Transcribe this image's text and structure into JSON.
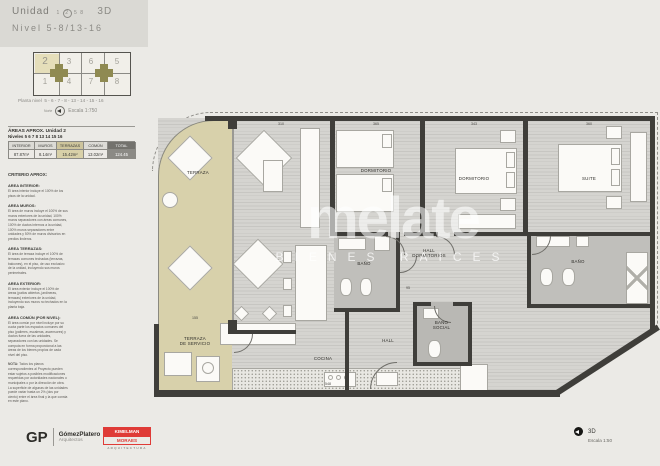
{
  "header": {
    "product_label": "Unidad",
    "unit_options": [
      "1",
      "2",
      "5",
      "8"
    ],
    "selected_unit": "2",
    "view_mode": "3D",
    "level_label": "Nivel",
    "level_range": "5-8/13-16"
  },
  "keyplan": {
    "cells": [
      "2",
      "3",
      "6",
      "5",
      "1",
      "4",
      "7",
      "8"
    ],
    "caption_label": "Planta nivel",
    "caption_levels": "5 - 6 - 7 - 8 - 13 - 14 - 15 - 16",
    "north_label": "Norte",
    "scale_label": "Escala 1:750"
  },
  "area_table": {
    "title": "ÁREAS APROX. Unidad 2",
    "subtitle": "Niveles 5 6 7 8 13 14 15 16",
    "columns": [
      "INTERIOR",
      "MUROS",
      "TERRAZAS",
      "COMÚN",
      "TOTAL"
    ],
    "values": [
      "87.87m²",
      "8.14m²",
      "15.42m²",
      "13.02m²",
      "124.45"
    ]
  },
  "criteria": {
    "heading": "CRITERIO APROX:",
    "sections": [
      {
        "title": "AREA INTERIOR:",
        "body": "El área interior incluye el 100% de los pisos de la unidad."
      },
      {
        "title": "AREA MUROS:",
        "body": "El área de muros incluye el 100% de sus muros exteriores de la unidad, 100% muros separadores con áreas comunes, 100% de ductos internos a la unidad, 100% muros separadores entre unidades y 50% de muros divisorios en predios linderos."
      },
      {
        "title": "AREA TERRAZAS:",
        "body": "El área de terraza incluye el 100% de terrazas comunes techadas (terrazas, balcones), en el piso, de uso exclusivo de la unidad, incluyendo sus muros perimetrales."
      },
      {
        "title": "AREA EXTERIOR:",
        "body": "El área exterior incluye el 100% de áreas (patios abiertos, jardineras, terrazas) exteriores de la unidad, incluyendo sus muros no techados en la planta baja."
      },
      {
        "title": "AREA COMÚN (POR NIVEL):",
        "body": "El área común por nivel incluye por su cuota parte los espacios comunes del piso (palieres, escaleras, ascensores) y ductos fuera de las unidades, separadores con las unidades. Se computa en forma proporcional a las áreas de los bienes propios de cada nivel del piso."
      }
    ],
    "note_title": "NOTA:",
    "note_body": "Todos los planos correspondientes al Proyecto pueden estar sujetos a posibles modificaciones requeridas por autoridades nacionales o municipales o por la dirección de obra. La superficie de algunas de las unidades puede variar hasta un 2% (dos por ciento) entre el área final y la que consta en este plano."
  },
  "plan": {
    "rooms": {
      "terraza": "TERRAZA",
      "dormitorio1": "DORMITORIO",
      "dormitorio2": "DORMITORIO",
      "suite": "SUITE",
      "hall_dormitorios": [
        "HALL",
        "DORMITORIOS"
      ],
      "bano1": "BAÑO",
      "bano_suite": "BAÑO",
      "bano_social": [
        "BAÑO",
        "SOCIAL"
      ],
      "hall": "HALL",
      "cocina": "COCINA",
      "terraza_servicio": [
        "TERRAZA",
        "DE SERVICIO"
      ]
    },
    "dimensions": {
      "living": "310",
      "dormitorio1": "365",
      "dormitorio2": "343",
      "suite": "360",
      "cocina": "548",
      "terraza": "155",
      "pasillo": "95"
    }
  },
  "watermark": {
    "brand": "melate",
    "tagline": "BIENES RAICES"
  },
  "footer": {
    "gp_initials": "GP",
    "gp_name": "GómezPlatero",
    "gp_subtitle": "Arquitectos",
    "partner_line1": "KIMELMAN",
    "partner_line2": "MORAES",
    "partner_subtitle": "ARQUITECTURA",
    "view_mode": "3D",
    "scale_label": "Escala 1:50"
  }
}
